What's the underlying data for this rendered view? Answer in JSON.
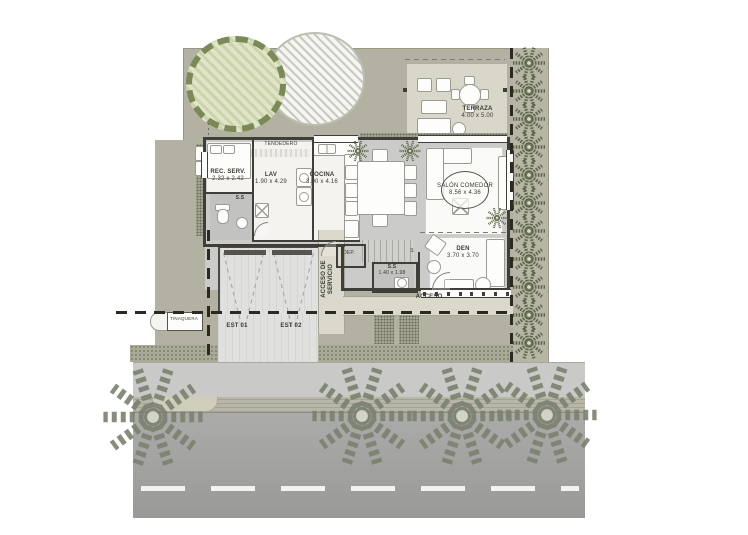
{
  "plan": {
    "rooms": {
      "rec_serv": {
        "name": "REC. SERV.",
        "dims": "2.32 x 2.42"
      },
      "lav": {
        "name": "LAV",
        "dims": "1.90 x 4.29"
      },
      "cocina": {
        "name": "COCINA",
        "dims": "3.00 x 4.16"
      },
      "salon_comedor": {
        "name": "SALÓN COMEDOR",
        "dims": "8.56 x 4.36"
      },
      "terraza": {
        "name": "TERRAZA",
        "dims": "4.00 x 5.00"
      },
      "den": {
        "name": "DEN",
        "dims": "3.70 x 3.70"
      },
      "bano_pb": {
        "name": "S.S",
        "dims": "1.40 x 1.98"
      }
    },
    "labels": {
      "tendedero": "TENDEDERO",
      "servicio_bano": "S.S",
      "dep": "DEP.",
      "stair": "S",
      "acceso": "ACCESO",
      "acceso_servicio_1": "ACCESO DE",
      "acceso_servicio_2": "SERVICIO",
      "est_01": "EST 01",
      "est_02": "EST 02",
      "tinaquera": "TINAQUERA"
    },
    "colors": {
      "lot": "#b2b1a2",
      "terrace": "#d9d7c9",
      "wall": "#3f3e39",
      "floor": "#cbcbc9",
      "sidewalk": "#c9c9c7",
      "road": "#a4a4a2",
      "palm": "#5c6647",
      "street_palm": "#7b8170"
    }
  }
}
